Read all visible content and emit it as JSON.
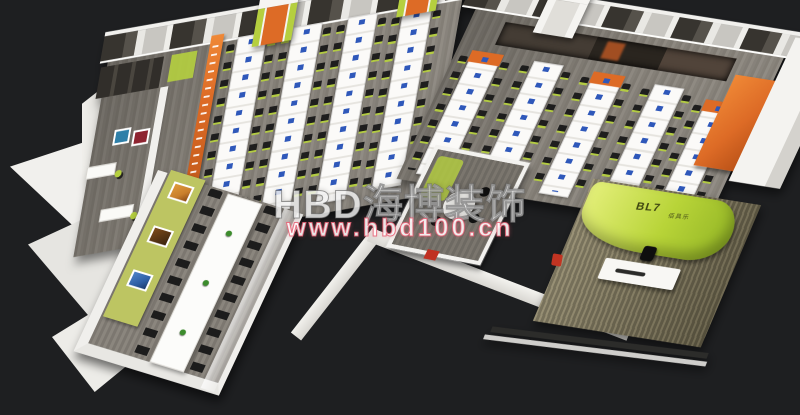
{
  "watermark": {
    "brand": "HBD海博装饰",
    "url": "www.hbd100.cn"
  },
  "reception_sign": {
    "logo": "BL7",
    "logo_sub": "佰具乐"
  },
  "palette": {
    "background": "#1e1f21",
    "accent_orange": "#dd6b26",
    "accent_lime": "#b5cf3f",
    "lime_bright": "#b8d438",
    "lime_wall": "#bdc562",
    "wall_white": "#f1f0ed",
    "carpet_gray": "#8a857d",
    "carpet_gold": "#8f8468",
    "chair_black": "#181818",
    "monitor_blue": "#2f58ba",
    "plant_green": "#3c8c2c",
    "art_teal": "#2e7fa8",
    "art_red": "#8e2430"
  }
}
